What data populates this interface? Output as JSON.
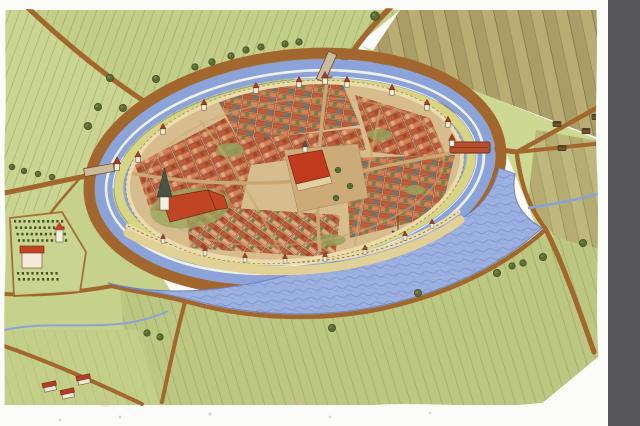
{
  "artwork": {
    "title": "Bird's-eye watercolour reconstruction of a medieval moated town beside a river",
    "medium": "hand-drawn pictorial map",
    "features": {
      "walled_town": "oval walled town with dense red-roofed houses",
      "moat": "double moat with water channels and yellow rampart ring",
      "ring_road": "brown road circling the moat",
      "river": "broad river along the south side of the town",
      "market_square": "central market square with town hall",
      "church": "parish church with tall dark spire",
      "manor": "small manor with orchard west of the town",
      "fields": "strip fields and meadows surrounding the town",
      "bridges": "west gate bridge, north gate bridge and covered east bridge",
      "farm": "farmstead in the south-west corner",
      "side_panel": "dark grey panel at right edge of window"
    }
  },
  "palette": {
    "paper": "#fbfbf7",
    "panel": "#58585a",
    "field-light": "#cbd592",
    "field-mid": "#c3ce88",
    "field-mid2": "#bcc781",
    "meadow": "#cdd892",
    "meadow2": "#c6d18b",
    "field-brown": "#b2a56b",
    "road": "#a2662f",
    "road-dark": "#6d4a20",
    "bridge-tan": "#cbbb9b",
    "moat-blue": "#8ba3d8",
    "moat-white": "#eef1ea",
    "moat-dark": "#5f76b8",
    "rampart": "#d7d482",
    "river": "#9db1e0",
    "river-line": "#6e88c6",
    "quay": "#e1d196",
    "wall": "#ecdcab",
    "wall-line": "#8b7747",
    "town-base": "#d7bd8d",
    "street": "#c9a873",
    "roof-red": "#c05a38",
    "roof-orange": "#d97f53",
    "roof-dark": "#a8452a",
    "roof-peach": "#e2a57e",
    "roof-green": "#75824a",
    "roof-teal": "#5e7b74",
    "landmark-red": "#c23a1f",
    "spire": "#475346",
    "tower-white": "#f4efe1",
    "tower-roof": "#a83c28",
    "tree": "#5c6c35",
    "tree-dark": "#42511f",
    "hut": "#6f5631",
    "churchyard": "#9aa65c",
    "courtyard": "#93a159"
  },
  "towers": {
    "ring": [
      {
        "x": 138,
        "y": 162
      },
      {
        "x": 163,
        "y": 134
      },
      {
        "x": 204,
        "y": 110
      },
      {
        "x": 256,
        "y": 93
      },
      {
        "x": 299,
        "y": 87
      },
      {
        "x": 347,
        "y": 87
      },
      {
        "x": 392,
        "y": 95
      },
      {
        "x": 427,
        "y": 110
      },
      {
        "x": 448,
        "y": 127
      }
    ],
    "gates": [
      {
        "x": 117,
        "y": 170,
        "s": 1.2
      },
      {
        "x": 325,
        "y": 84,
        "s": 1.15
      },
      {
        "x": 452,
        "y": 146,
        "s": 1.1
      }
    ],
    "south": [
      {
        "x": 163,
        "y": 243,
        "s": 0.85
      },
      {
        "x": 205,
        "y": 255,
        "s": 0.85
      },
      {
        "x": 245,
        "y": 262,
        "s": 0.85
      },
      {
        "x": 285,
        "y": 263,
        "s": 0.85
      },
      {
        "x": 325,
        "y": 261,
        "s": 0.85
      },
      {
        "x": 365,
        "y": 254,
        "s": 0.85
      },
      {
        "x": 405,
        "y": 240,
        "s": 0.85
      },
      {
        "x": 432,
        "y": 228,
        "s": 0.85
      }
    ]
  },
  "bushes": [
    {
      "x": 195,
      "y": 67,
      "s": 0.9
    },
    {
      "x": 212,
      "y": 62,
      "s": 0.9
    },
    {
      "x": 231,
      "y": 56,
      "s": 0.9
    },
    {
      "x": 246,
      "y": 50,
      "s": 0.9
    },
    {
      "x": 261,
      "y": 47,
      "s": 0.9
    },
    {
      "x": 285,
      "y": 44,
      "s": 0.9
    },
    {
      "x": 299,
      "y": 42,
      "s": 0.9
    },
    {
      "x": 110,
      "y": 78,
      "s": 1
    },
    {
      "x": 98,
      "y": 107,
      "s": 1
    },
    {
      "x": 123,
      "y": 108,
      "s": 1
    },
    {
      "x": 156,
      "y": 79,
      "s": 1
    },
    {
      "x": 88,
      "y": 126,
      "s": 1
    },
    {
      "x": 12,
      "y": 167,
      "s": 0.8
    },
    {
      "x": 24,
      "y": 171,
      "s": 0.8
    },
    {
      "x": 38,
      "y": 174,
      "s": 0.8
    },
    {
      "x": 52,
      "y": 177,
      "s": 0.8
    },
    {
      "x": 375,
      "y": 16,
      "s": 1.2
    },
    {
      "x": 332,
      "y": 328,
      "s": 1
    },
    {
      "x": 418,
      "y": 293,
      "s": 1
    },
    {
      "x": 497,
      "y": 273,
      "s": 1
    },
    {
      "x": 512,
      "y": 266,
      "s": 0.9
    },
    {
      "x": 523,
      "y": 263,
      "s": 0.9
    },
    {
      "x": 543,
      "y": 257,
      "s": 1
    },
    {
      "x": 583,
      "y": 243,
      "s": 1
    },
    {
      "x": 160,
      "y": 337,
      "s": 0.9
    },
    {
      "x": 147,
      "y": 333,
      "s": 0.9
    }
  ],
  "huts": [
    {
      "x": 557,
      "y": 124
    },
    {
      "x": 586,
      "y": 131
    },
    {
      "x": 562,
      "y": 148
    },
    {
      "x": 596,
      "y": 117
    }
  ],
  "square_trees": [
    {
      "x": 338,
      "y": 170
    },
    {
      "x": 350,
      "y": 186
    },
    {
      "x": 336,
      "y": 198
    }
  ],
  "farm_buildings": [
    {
      "x": 50,
      "y": 388
    },
    {
      "x": 68,
      "y": 395
    },
    {
      "x": 84,
      "y": 381
    }
  ],
  "orchard_blocks": [
    {
      "x0": 14,
      "y0": 220,
      "cols": 11,
      "rows": 4,
      "dx": 4.7,
      "dy": 6.4,
      "slant": 1.3
    },
    {
      "x0": 17,
      "y0": 272,
      "cols": 9,
      "rows": 2,
      "dx": 4.8,
      "dy": 6.0,
      "slant": 1.0
    }
  ]
}
